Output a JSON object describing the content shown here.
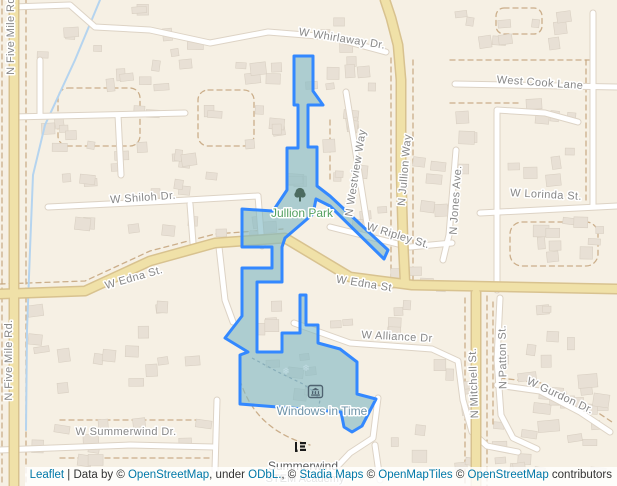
{
  "map": {
    "street_labels": [
      {
        "text": "W Whirlaway Dr.",
        "x": 342,
        "y": 39,
        "rot": 9
      },
      {
        "text": "West Cook Lane",
        "x": 540,
        "y": 83,
        "rot": 4
      },
      {
        "text": "W Shiloh Dr.",
        "x": 143,
        "y": 198,
        "rot": -4
      },
      {
        "text": "N Five Mile Rd",
        "x": 11,
        "y": 36,
        "rot": -90
      },
      {
        "text": "N Five Mile Rd.",
        "x": 9,
        "y": 360,
        "rot": -90
      },
      {
        "text": "W Edna St.",
        "x": 134,
        "y": 278,
        "rot": -16
      },
      {
        "text": "W Edna St",
        "x": 364,
        "y": 284,
        "rot": 9
      },
      {
        "text": "W Ripley St.",
        "x": 398,
        "y": 236,
        "rot": 17
      },
      {
        "text": "N Westview Way",
        "x": 356,
        "y": 173,
        "rot": -81
      },
      {
        "text": "N Jullion Way",
        "x": 405,
        "y": 170,
        "rot": -85
      },
      {
        "text": "N Jones Ave.",
        "x": 456,
        "y": 200,
        "rot": -86
      },
      {
        "text": "W Lorinda St.",
        "x": 546,
        "y": 195,
        "rot": 3
      },
      {
        "text": "W Alliance Dr",
        "x": 397,
        "y": 337,
        "rot": 3
      },
      {
        "text": "N Mitchell St.",
        "x": 474,
        "y": 383,
        "rot": -92
      },
      {
        "text": "N Patton St.",
        "x": 503,
        "y": 357,
        "rot": -91
      },
      {
        "text": "W Gurdon Dr.",
        "x": 560,
        "y": 396,
        "rot": 25
      },
      {
        "text": "W Summerwind Dr.",
        "x": 126,
        "y": 432,
        "rot": 0
      }
    ],
    "poi_labels": [
      {
        "text": "Jullion Park",
        "x": 302,
        "y": 213,
        "kind": "park"
      },
      {
        "text": "Windows in Time",
        "x": 322,
        "y": 411,
        "kind": "museum"
      },
      {
        "text": "Summerwind",
        "x": 303,
        "y": 466,
        "kind": "school"
      },
      {
        "text": "STEM Academy",
        "x": 305,
        "y": 479,
        "kind": "school-sub"
      }
    ],
    "icons": [
      {
        "name": "tree-icon",
        "poi": "Jullion Park"
      },
      {
        "name": "museum-icon",
        "poi": "Windows in Time"
      },
      {
        "name": "school-icon",
        "poi": "Summerwind STEM Academy"
      }
    ],
    "highlight_region": {
      "description": "blue highlighted boundary polygon over Jullion Park / Windows in Time area",
      "stroke": "#3388ff",
      "fill": "#80b8c4",
      "fill_opacity": 0.62
    },
    "colors": {
      "land": "#f6f0e4",
      "major_road": "#f0e1a8",
      "major_road_casing": "#d8c28f",
      "minor_road": "#ffffff",
      "street_label": "#878787",
      "park_label": "#55a061",
      "museum_label": "#6e93a8",
      "school_label": "#595959",
      "stream": "#b5d4ef",
      "link_blue": "#0078A8"
    }
  },
  "attribution": {
    "segments": [
      {
        "text": "Leaflet",
        "link": true
      },
      {
        "text": " | Data by © ",
        "link": false
      },
      {
        "text": "OpenStreetMap",
        "link": true
      },
      {
        "text": ", under ",
        "link": false
      },
      {
        "text": "ODbL.",
        "link": true
      },
      {
        "text": ", © ",
        "link": false
      },
      {
        "text": "Stadia Maps",
        "link": true
      },
      {
        "text": " © ",
        "link": false
      },
      {
        "text": "OpenMapTiles",
        "link": true
      },
      {
        "text": " © ",
        "link": false
      },
      {
        "text": "OpenStreetMap",
        "link": true
      },
      {
        "text": " contributors",
        "link": false
      }
    ]
  }
}
